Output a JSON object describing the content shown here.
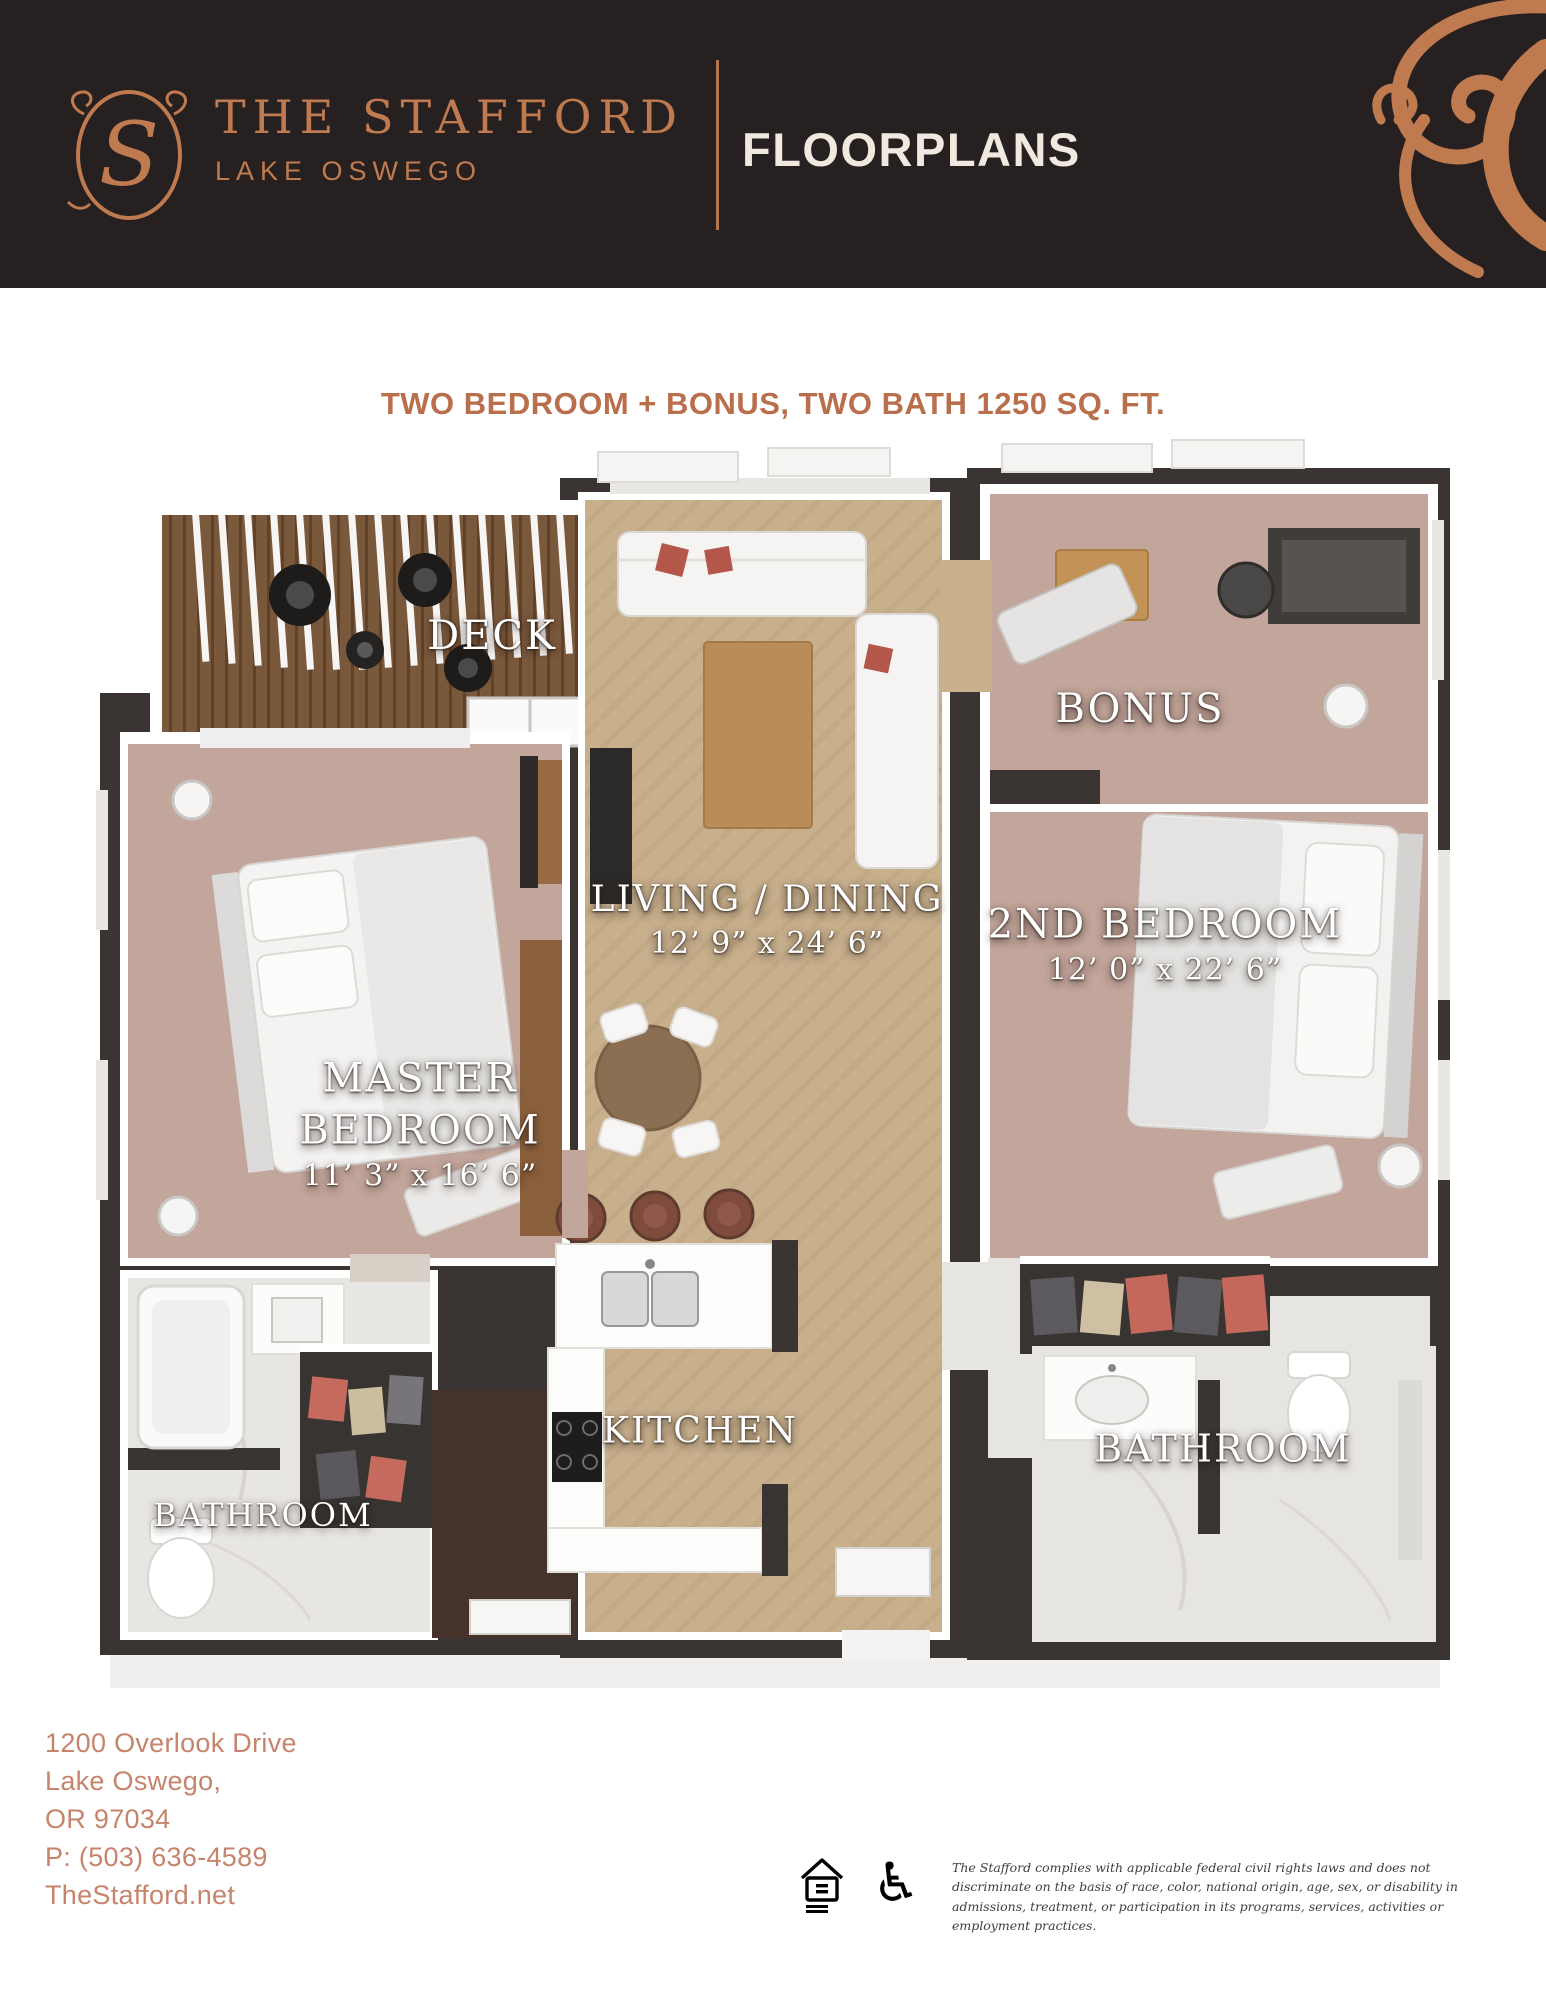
{
  "header": {
    "logo_monogram": "S",
    "brand_name": "THE STAFFORD",
    "brand_subtitle": "LAKE OSWEGO",
    "page_title": "FLOORPLANS"
  },
  "plan": {
    "title": "TWO BEDROOM + BONUS, TWO BATH 1250 SQ. FT.",
    "rooms": [
      {
        "id": "deck",
        "label": "DECK",
        "dims": ""
      },
      {
        "id": "living_dining",
        "label": "LIVING / DINING",
        "dims": "12’ 9” x 24’ 6”"
      },
      {
        "id": "bonus",
        "label": "BONUS",
        "dims": ""
      },
      {
        "id": "second_bedroom",
        "label": "2ND BEDROOM",
        "dims": "12’ 0” x 22’ 6”"
      },
      {
        "id": "master_bedroom",
        "label": "MASTER BEDROOM",
        "dims": "11’ 3” x 16’ 6”"
      },
      {
        "id": "kitchen",
        "label": "KITCHEN",
        "dims": ""
      },
      {
        "id": "master_bathroom",
        "label": "BATHROOM",
        "dims": ""
      },
      {
        "id": "second_bathroom",
        "label": "BATHROOM",
        "dims": ""
      }
    ]
  },
  "footer": {
    "address_line1": "1200 Overlook Drive",
    "address_line2": "Lake Oswego,",
    "address_line3": "OR 97034",
    "phone": "P: (503) 636-4589",
    "website": "TheStafford.net",
    "icons": [
      "equal-housing-icon",
      "accessibility-icon"
    ],
    "disclaimer": "The Stafford complies with applicable federal civil rights laws and does not discriminate on the basis of race, color, national origin, age, sex, or disability in admissions, treatment, or participation in its programs, services, activities or employment practices."
  },
  "colors": {
    "header_bg": "#262120",
    "copper": "#c07a50",
    "title_copper": "#b96f4b",
    "address_copper": "#c5846b",
    "cream": "#efe9df",
    "wall_dark": "#3a3533",
    "carpet_mauve": "#c2a59b",
    "wood_floor_tan": "#c8b08d",
    "deck_wood": "#7a583c",
    "marble": "#e8e6e2",
    "label_white": "#ffffff"
  }
}
